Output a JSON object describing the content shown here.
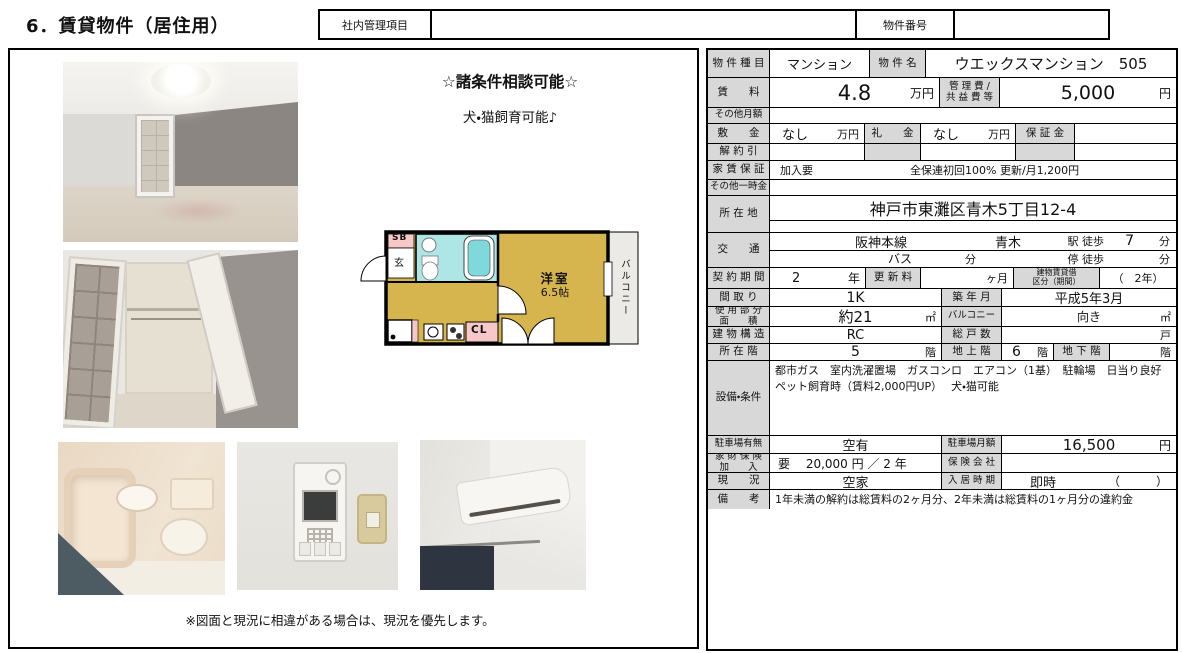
{
  "page": {
    "title": "6．賃貸物件（居住用）"
  },
  "header": {
    "internal_label": "社内管理項目",
    "property_no_label": "物件番号"
  },
  "promo": {
    "line1": "☆諸条件相談可能☆",
    "line2": "犬・猫飼育可能♪"
  },
  "floorplan": {
    "sb": "SB",
    "entrance": "玄",
    "closet": "CL",
    "room_name": "洋室",
    "room_size": "6.5帖",
    "balcony": "バルコニー"
  },
  "caption": "※図面と現況に相違がある場合は、現況を優先します。",
  "table": {
    "property_type_label": "物 件 種 目",
    "property_type": "マンション",
    "property_name_label": "物 件 名",
    "property_name": "ウエックスマンション　505",
    "rent_label": "賃　　料",
    "rent_value": "4.8",
    "rent_unit": "万円",
    "mgmt_fee_label_1": "管 理 費 /",
    "mgmt_fee_label_2": "共 益 費 等",
    "mgmt_fee_value": "5,000",
    "mgmt_fee_unit": "円",
    "other_monthly_label": "その他月額",
    "deposit_label": "敷　　金",
    "deposit_value": "なし",
    "deposit_unit": "万円",
    "key_money_label": "礼　　金",
    "key_money_value": "なし",
    "key_money_unit": "万円",
    "guarantee_money_label": "保 証 金",
    "cancellation_label": "解 約 引",
    "rent_guarantee_label": "家 賃 保 証",
    "rent_guarantee_value": "加入要",
    "rent_guarantee_detail": "全保連初回100% 更新/月1,200円",
    "other_onetime_label": "その他一時金",
    "address_label": "所 在 地",
    "address": "神戸市東灘区青木5丁目12-4",
    "transport_label": "交　　通",
    "train_line": "阪神本線",
    "station": "青木",
    "station_suffix": "駅 徒歩",
    "walk_minutes": "7",
    "minutes_unit": "分",
    "bus_label": "バス",
    "bus_minutes_unit": "分",
    "stop_suffix": "停 徒歩",
    "stop_minutes_unit": "分",
    "contract_label": "契 約 期 間",
    "contract_years": "2",
    "contract_unit": "年",
    "renewal_label": "更 新 料",
    "renewal_unit": "ヶ月",
    "lease_type_label_1": "建物賃貸借",
    "lease_type_label_2": "区分（期間）",
    "lease_type_value": "（　2年）",
    "layout_label": "間 取 り",
    "layout_value": "1K",
    "built_label": "築 年 月",
    "built_value": "平成5年3月",
    "area_label_1": "使 用 部 分",
    "area_label_2": "面　　積",
    "area_value": "約21",
    "area_unit": "㎡",
    "balcony_label": "バルコニー",
    "facing_label": "向き",
    "balcony_unit": "㎡",
    "structure_label": "建 物 構 造",
    "structure_value": "RC",
    "total_units_label": "総 戸 数",
    "total_units_unit": "戸",
    "floor_label": "所 在 階",
    "floor_value": "5",
    "floor_unit": "階",
    "floors_above_label": "地 上 階",
    "floors_above_value": "6",
    "floors_above_unit": "階",
    "floors_below_label": "地 下 階",
    "floors_below_unit": "階",
    "equipment_label": "設備・条件",
    "equipment_text": "都市ガス　室内洗濯置場　ガスコンロ　エアコン（1基）　駐輪場　日当り良好\nペット飼育時（賃料2,000円UP）　 犬・猫可能",
    "parking_label": "駐車場有無",
    "parking_value": "空有",
    "parking_fee_label": "駐車場月額",
    "parking_fee_value": "16,500",
    "parking_fee_unit": "円",
    "insurance_label_1": "家 財 保 険",
    "insurance_label_2": "加　　入",
    "insurance_value": "要　 20,000 円 ／ 2 年",
    "insurer_label": "保 険 会 社",
    "status_label": "現　　況",
    "status_value": "空家",
    "movein_label": "入 居 時 期",
    "movein_value": "即時",
    "movein_paren": "（　　　）",
    "remarks_label": "備　　考",
    "remarks_text": "1年未満の解約は総賃料の2ヶ月分、2年未満は総賃料の1ヶ月分の違約金"
  },
  "colors": {
    "label-gray": "#d8d8d8",
    "room-tan": "#d7b54e",
    "bath-cyan": "#aee6e6",
    "accent-pink": "#f6c8c8"
  }
}
